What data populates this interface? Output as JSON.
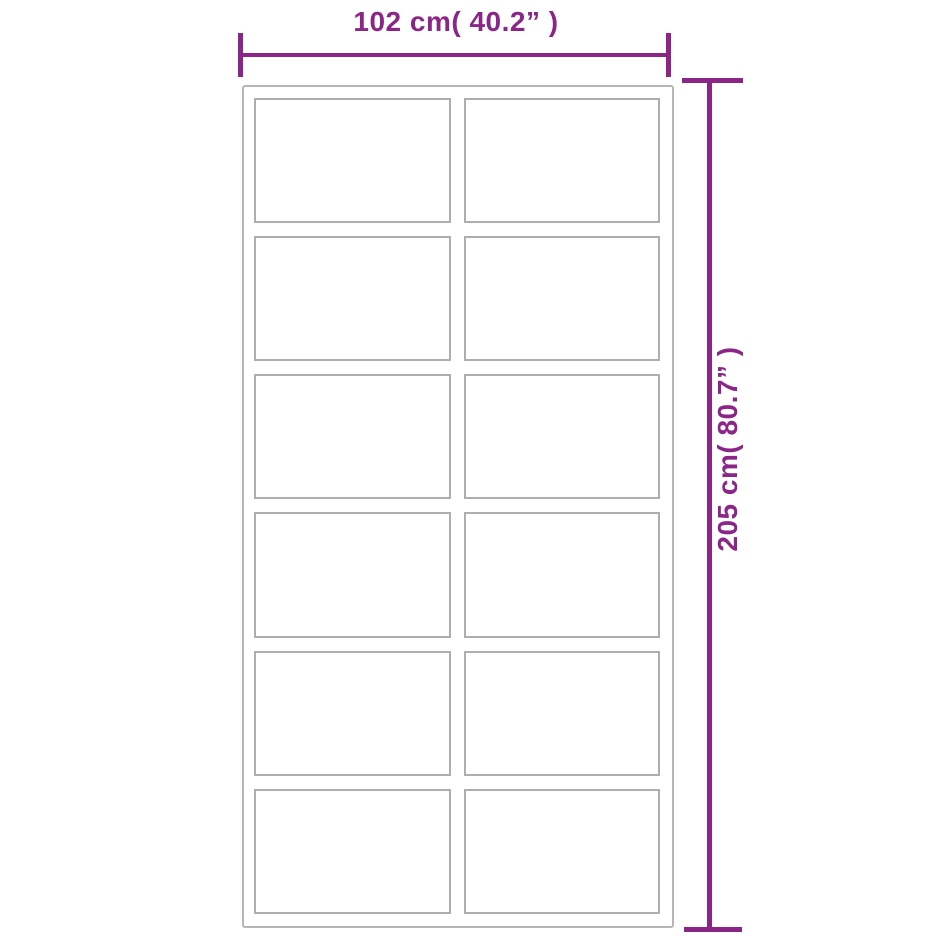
{
  "diagram": {
    "title": "product dimension diagram",
    "width_label": "102 cm( 40.2” )",
    "height_label": "205 cm( 80.7” )",
    "panels": {
      "rows": 6,
      "columns": 2,
      "count": 12
    },
    "colors": {
      "dimension_accent": "#8b2688",
      "frame_line": "#b6b6b6",
      "panel_line": "#aeaeae",
      "background": "#ffffff"
    }
  }
}
